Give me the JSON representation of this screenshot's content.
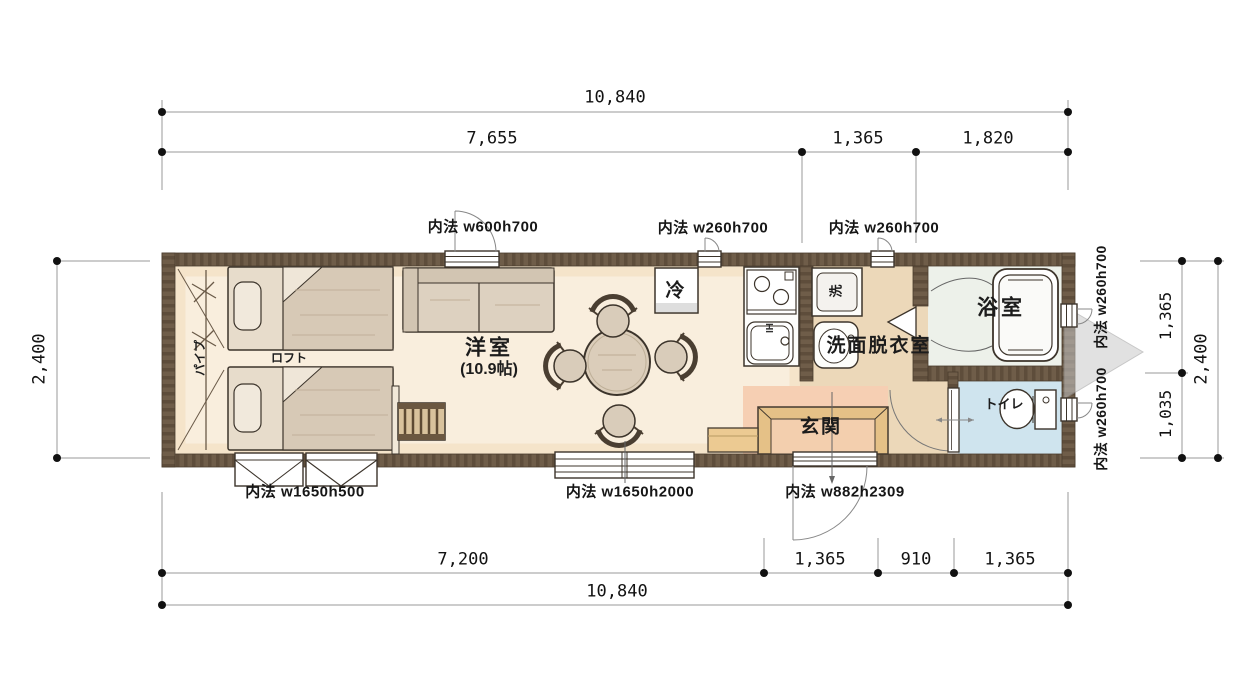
{
  "dims": {
    "top_overall": "10,840",
    "top_a": "7,655",
    "top_b": "1,365",
    "top_c": "1,820",
    "bottom_a": "7,200",
    "bottom_b": "1,365",
    "bottom_c": "910",
    "bottom_d": "1,365",
    "bottom_overall": "10,840",
    "left_overall": "2,400",
    "right_a": "1,365",
    "right_b": "1,035",
    "right_overall": "2,400"
  },
  "rooms": {
    "living": "洋室",
    "living_size": "(10.9帖)",
    "loft": "ロフト",
    "pipe": "パイプ",
    "fridge": "冷",
    "stove_ih": "IH",
    "washer": "洗",
    "washroom": "洗面脱衣室",
    "bath": "浴室",
    "toilet": "トイレ",
    "entrance": "玄関"
  },
  "openings": {
    "top_window_main": "内法 w600h700",
    "top_window_kitchen": "内法 w260h700",
    "top_window_washroom": "内法 w260h700",
    "right_window_bath": "内法 w260h700",
    "right_window_toilet": "内法 w260h700",
    "bottom_window_loft": "内法 w1650h500",
    "bottom_window_living": "内法 w1650h2000",
    "entrance_door": "内法 w882h2309"
  },
  "colors": {
    "wall": "#6f5d49",
    "floor_living": "#f9eedd",
    "floor_washroom": "#ecd8b9",
    "floor_entrance": "#f6cfb3",
    "floor_bath": "#edf1ea",
    "floor_toilet": "#cfe4ee",
    "platform": "#e5c187",
    "furniture": "#d9ccba",
    "hitch": "#c9c9c9"
  }
}
